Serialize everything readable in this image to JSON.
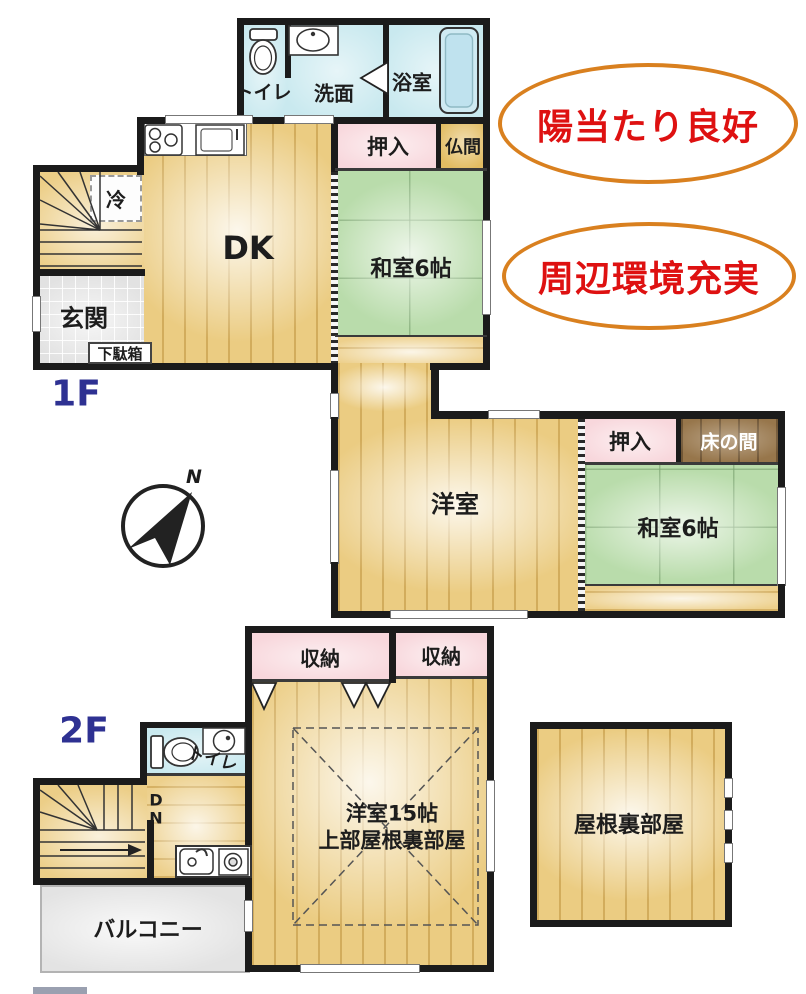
{
  "floor1": {
    "floor_label": "1F",
    "toilet": "トイレ",
    "washroom": "洗面",
    "bath": "浴室",
    "closet_top": "押入",
    "butsuma": "仏間",
    "fridge": "冷",
    "dk": "DK",
    "tatami_top": "和室6帖",
    "entrance": "玄関",
    "shoe_box": "下駄箱",
    "western_room": "洋室",
    "closet_mid": "押入",
    "tokonoma": "床の間",
    "tatami_mid": "和室6帖"
  },
  "floor2": {
    "floor_label": "2F",
    "toilet": "トイレ",
    "down_mark": "DN",
    "storage_left": "収納",
    "storage_right": "収納",
    "room15_line1": "洋室15帖",
    "room15_line2": "上部屋根裏部屋",
    "balcony": "バルコニー",
    "attic": "屋根裏部屋"
  },
  "badges": {
    "sunlight": "陽当たり良好",
    "environment": "周辺環境充実"
  },
  "compass": {
    "north": "N"
  },
  "colors": {
    "wall": "#1b1b1b",
    "wood_floor": "#ebcc82",
    "tatami_green": "#b9dcab",
    "closet_pink": "#f8d7dc",
    "water_blue": "#c9e9ef",
    "tile_gray": "#e2e2e2",
    "butsuma_gold": "#e2bc62",
    "tokonoma_brown": "#97764b",
    "badge_border": "#d9801f",
    "badge_text": "#de1111",
    "floor_label_blue": "#2e3192"
  }
}
